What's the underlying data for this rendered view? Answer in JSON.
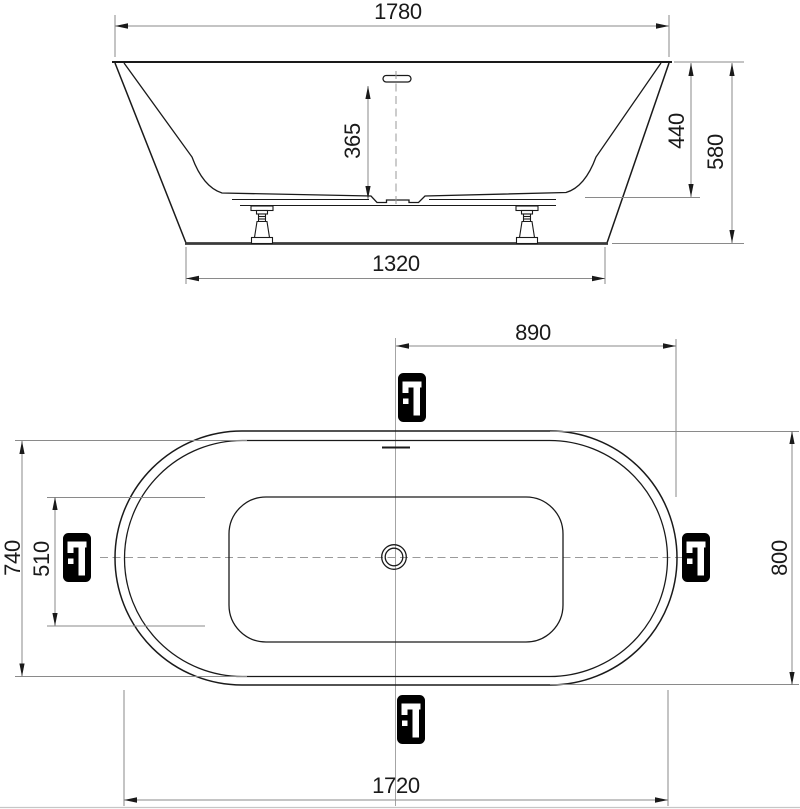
{
  "drawing": {
    "title": "bathtub-technical-drawing",
    "side_view": {
      "dims": {
        "overall_length": "1780",
        "depth_to_overflow": "365",
        "inner_depth": "440",
        "overall_height": "580",
        "base_length": "1320"
      }
    },
    "plan_view": {
      "dims": {
        "center_to_end": "890",
        "inner_width": "740",
        "floor_width": "510",
        "overall_width": "800",
        "inner_length": "1720"
      },
      "faucet_positions": [
        "top",
        "left",
        "right",
        "bottom"
      ]
    },
    "colors": {
      "outline": "#1a1a1a",
      "dimension_lines": "#8a8a8a",
      "centerline": "#9a9a9a",
      "icon_background": "#000000",
      "background": "#ffffff"
    }
  }
}
